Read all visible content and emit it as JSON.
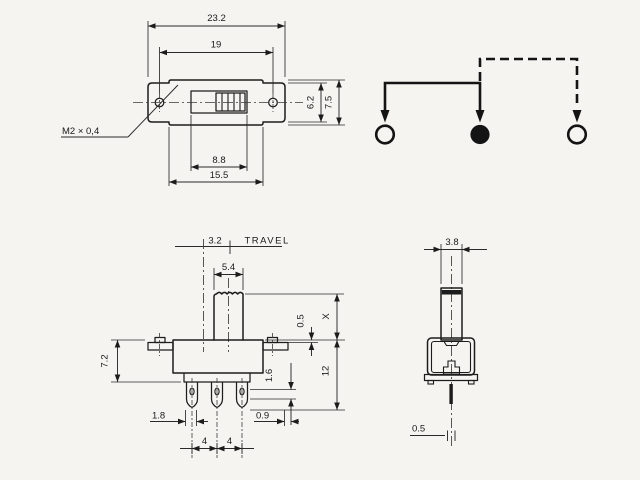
{
  "drawing_title": "slide switch dimensional drawing",
  "colors": {
    "background": "#f5f4f1",
    "line": "#1c1c1c",
    "filled_terminal": "#141414",
    "knob_band": "#1c1c1c"
  },
  "labels": {
    "top": {
      "overall_width": "23.2",
      "hole_spacing": "19",
      "ear_height": "6.2",
      "body_height": "7.5",
      "slot_width": "8.8",
      "center_width": "15.5",
      "thread": "M2 × 0,4"
    },
    "front": {
      "travel": "3.2",
      "travel_word": "TRAVEL",
      "knob_width": "5.4",
      "body_height": "7.2",
      "pin_width": "1.8",
      "pitch_a": "4",
      "pitch_b": "4",
      "pin_thickness": "0.9",
      "step": "1.6",
      "ear_gap": "0.5",
      "knob_height": "X",
      "total_height": "12"
    },
    "side": {
      "knob_depth": "3.8",
      "pin_dia": "0.5"
    }
  },
  "schematic": {
    "terminal_count": 3,
    "terminals": [
      {
        "position": "left",
        "state": "open"
      },
      {
        "position": "center",
        "state": "filled"
      },
      {
        "position": "right",
        "state": "open"
      }
    ],
    "solid_link": "left-to-center",
    "dashed_link": "center-to-right"
  }
}
